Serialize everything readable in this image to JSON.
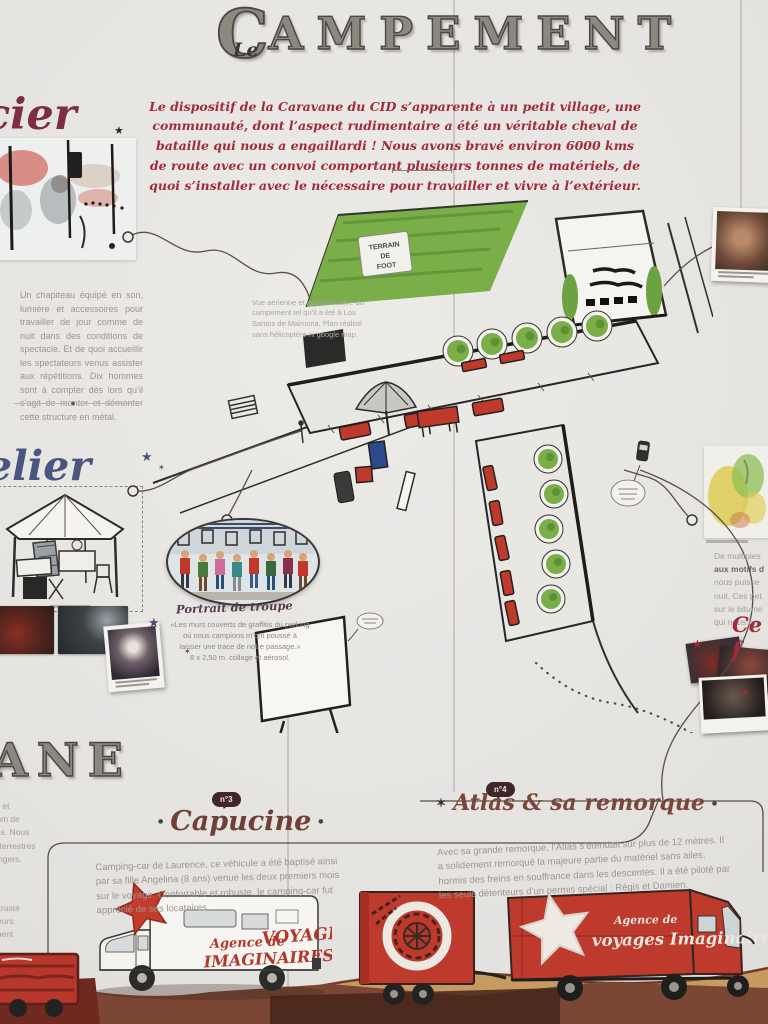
{
  "title": {
    "le": "Le",
    "c": "C",
    "rest": "AMPEMENT"
  },
  "intro": "Le dispositif de la Caravane du CID s’apparente à un petit village, une communauté, dont l’aspect rudimentaire a été un véritable cheval de bataille qui nous a engaillardi !  Nous avons bravé environ 6000 kms de route avec un convoi comportant plusieurs tonnes de matériels, de quoi s’installer avec le nécessaire pour travailler et vivre à l’extérieur.",
  "left": {
    "heading_fragment": "cier",
    "star": "★",
    "chapiteau_text": "Un chapiteau équipé en son, lumière et accessoires pour travailler de jour comme de nuit dans des conditions de spectacle. Et de quoi accueillir les spectateurs venus assister aux répétitions. Dix hommes sont à compter dès lors qu’il s’agit de monter et démonter cette structure en métal.",
    "divider_glyph": "◆",
    "atelier_fragment": "elier",
    "star_big": "★",
    "star_small": "✶"
  },
  "map": {
    "field_sign": {
      "l1": "TERRAIN",
      "l2": "DE",
      "l3": "FOOT"
    },
    "caption": "Vue aérienne et approximative du campement tel qu’il a été à Los Santos de Maimona. Plan réalisé sans hélicoptère ni google map.",
    "portrait_title": "Portrait de troupe",
    "portrait_caption": "«Les murs couverts de graffitis du parking\noù nous campions m’ont poussé à\nlaisser une trace de notre passage.»\n8 x 2,50 m. collage et aérosol."
  },
  "right": {
    "lines": [
      "De multiples",
      "aux motifs d",
      "nous puisse",
      "nuit. Ces pet",
      "sur le bitume",
      "qui nous on"
    ],
    "heading_fragment": "Ce f",
    "star": "★"
  },
  "bottom": {
    "chapter_fragment": "ANE",
    "edge_fragment_1": "re à bord et\nets au nom de\nt déplacés. Nous\nes voies terrestres\nsols étrangers.",
    "edge_fragment_2": "ne a contrasté\nses couleurs\ngréablement",
    "capucine": {
      "badge": "n°3",
      "title": "Capucine",
      "dot": "●",
      "text": "Camping-car de Laurence, ce véhicule a été baptisé ainsi par sa fille Angelina (8 ans) venue les deux premiers mois sur le voyage. Confortable et robuste, le camping-car fut apprécié de ses locataires."
    },
    "atlas": {
      "badge": "n°4",
      "title": "Atlas & sa remorque",
      "star": "✶",
      "dot": "●",
      "text": "Avec sa grande remorque, l’Atlas s’étendait sur plus de 12 mètres. Il a solidement remorqué la majeure partie du matériel sans ailes, hormis des freins en souffrance dans les descentes. Il a été piloté par les seuls détenteurs d’un permis spécial : Régis et Damien."
    }
  },
  "vehicles": {
    "campingcar": {
      "l1": "Agence de",
      "l2": "VOYAGES",
      "l3": "IMAGINAIRES"
    },
    "van": {
      "l1": "Agence de",
      "l2": "voyages Imaginaires"
    }
  },
  "colors": {
    "accent_red": "#a22a3a",
    "truck_red": "#bd3a2c",
    "map_green": "#79ae49",
    "ground_brown": "#7c4634",
    "script_blue": "#4a5580"
  }
}
